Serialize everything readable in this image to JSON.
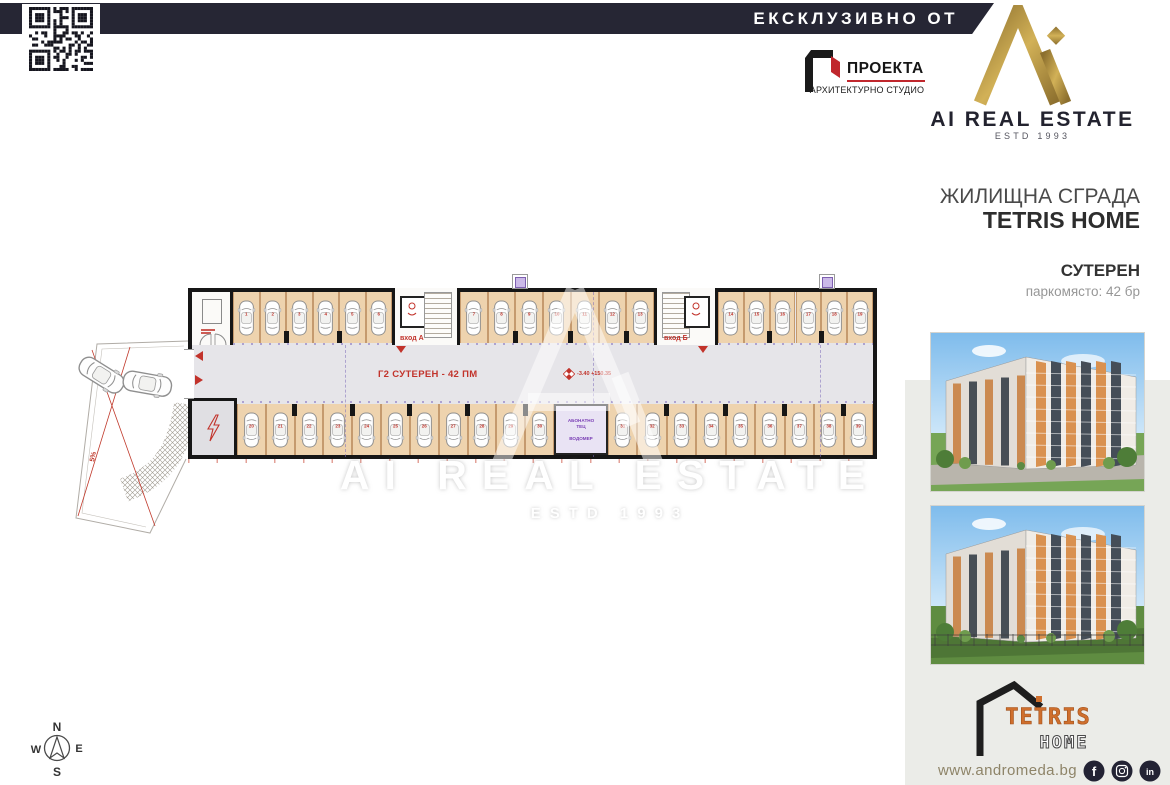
{
  "banner": {
    "text": "ЕКСКЛУЗИВНО ОТ"
  },
  "brand": {
    "name": "AI REAL ESTATE",
    "estd": "ESTD 1993",
    "gold_color": "#a6873c",
    "navy_color": "#262634"
  },
  "architect": {
    "name": "ПРОЕКТА",
    "subtitle": "АРХИТЕКТУРНО СТУДИО",
    "accent_color": "#c0272d"
  },
  "project": {
    "building_type": "ЖИЛИЩНА СГРАДА",
    "name": "TETRIS HOME",
    "level": "СУТЕРЕН",
    "parking_info": "паркомясто: 42 бр"
  },
  "plan": {
    "zone_label": "Г2 СУТЕРЕН - 42 ПМ",
    "elevation_label": "-3.40 +150.35",
    "entrance_a_label": "вход А",
    "entrance_b_label": "вход Б",
    "utility_room_lines": [
      "АБОНАТНО",
      "ТЕЦ",
      "ВОДОМЕР"
    ],
    "slope_label": "5%",
    "stall_count": 42,
    "stall_fill_color": "#eed3ae",
    "label_color": "#c2332b",
    "segments": [
      {
        "row": "top",
        "x1": 233,
        "x2": 392,
        "count": 6
      },
      {
        "row": "top",
        "x1": 460,
        "x2": 654,
        "count": 7
      },
      {
        "row": "top",
        "x1": 718,
        "x2": 873,
        "count": 6
      },
      {
        "row": "bottom",
        "x1": 237,
        "x2": 554,
        "count": 11
      },
      {
        "row": "bottom",
        "x1": 608,
        "x2": 873,
        "count": 9
      }
    ]
  },
  "watermark": {
    "title": "AI REAL ESTATE",
    "estd": "ESTD 1993"
  },
  "compass": {
    "north": "N",
    "south": "S",
    "east": "E",
    "west": "W"
  },
  "sidebar_photos": [
    "building-render-1",
    "building-render-2"
  ],
  "tetris_logo": {
    "title": "TETRIS",
    "subtitle": "HOME",
    "orange_color": "#cf6f2d"
  },
  "footer": {
    "website": "www.andromeda.bg",
    "social": [
      "facebook",
      "instagram",
      "linkedin"
    ]
  }
}
